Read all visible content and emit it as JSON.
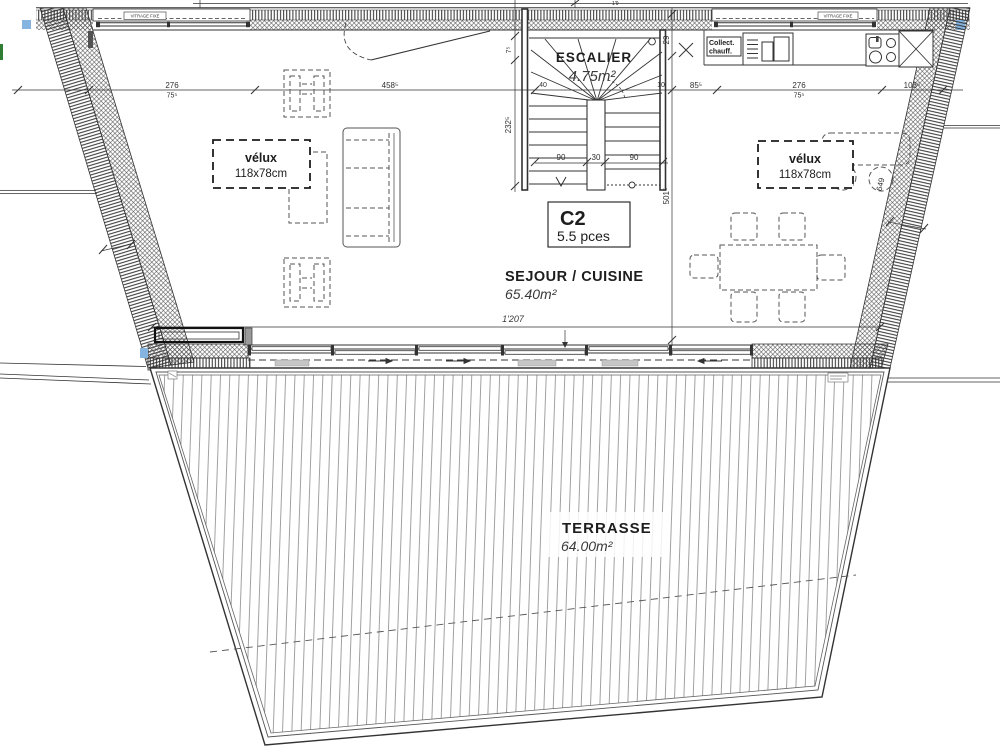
{
  "unit": {
    "code": "C2",
    "pieces": "5.5 pces"
  },
  "rooms": {
    "stair": {
      "name": "ESCALIER",
      "area": "4.75m²"
    },
    "living": {
      "name": "SEJOUR / CUISINE",
      "area": "65.40m²"
    },
    "terrace": {
      "name": "TERRASSE",
      "area": "64.00m²"
    }
  },
  "skylights": {
    "left": {
      "label": "vélux",
      "size": "118x78cm"
    },
    "right": {
      "label": "vélux",
      "size": "118x78cm"
    }
  },
  "labels": {
    "vitrage_left": "VITRAGE FIXE",
    "vitrage_right": "VITRAGE FIXE",
    "collect_line1": "Collect.",
    "collect_line2": "chauff."
  },
  "dims": {
    "d276a": "276",
    "d75a": "75⁵",
    "d458": "458⁵",
    "d40": "40",
    "d10": "10",
    "d85": "85⁵",
    "d276b": "276",
    "d75b": "75⁵",
    "d103": "103⁵",
    "d7": "7⁵",
    "d232": "232⁵",
    "d29": "29",
    "d501": "501⁵",
    "d649": "649",
    "d1207": "1'207",
    "d90a": "90",
    "d30": "30",
    "d90b": "90",
    "top_partial": "1'9"
  },
  "colors": {
    "ink": "#333333",
    "highlight_blue": "#85b4e0",
    "boundary_green": "#2e7d32"
  }
}
